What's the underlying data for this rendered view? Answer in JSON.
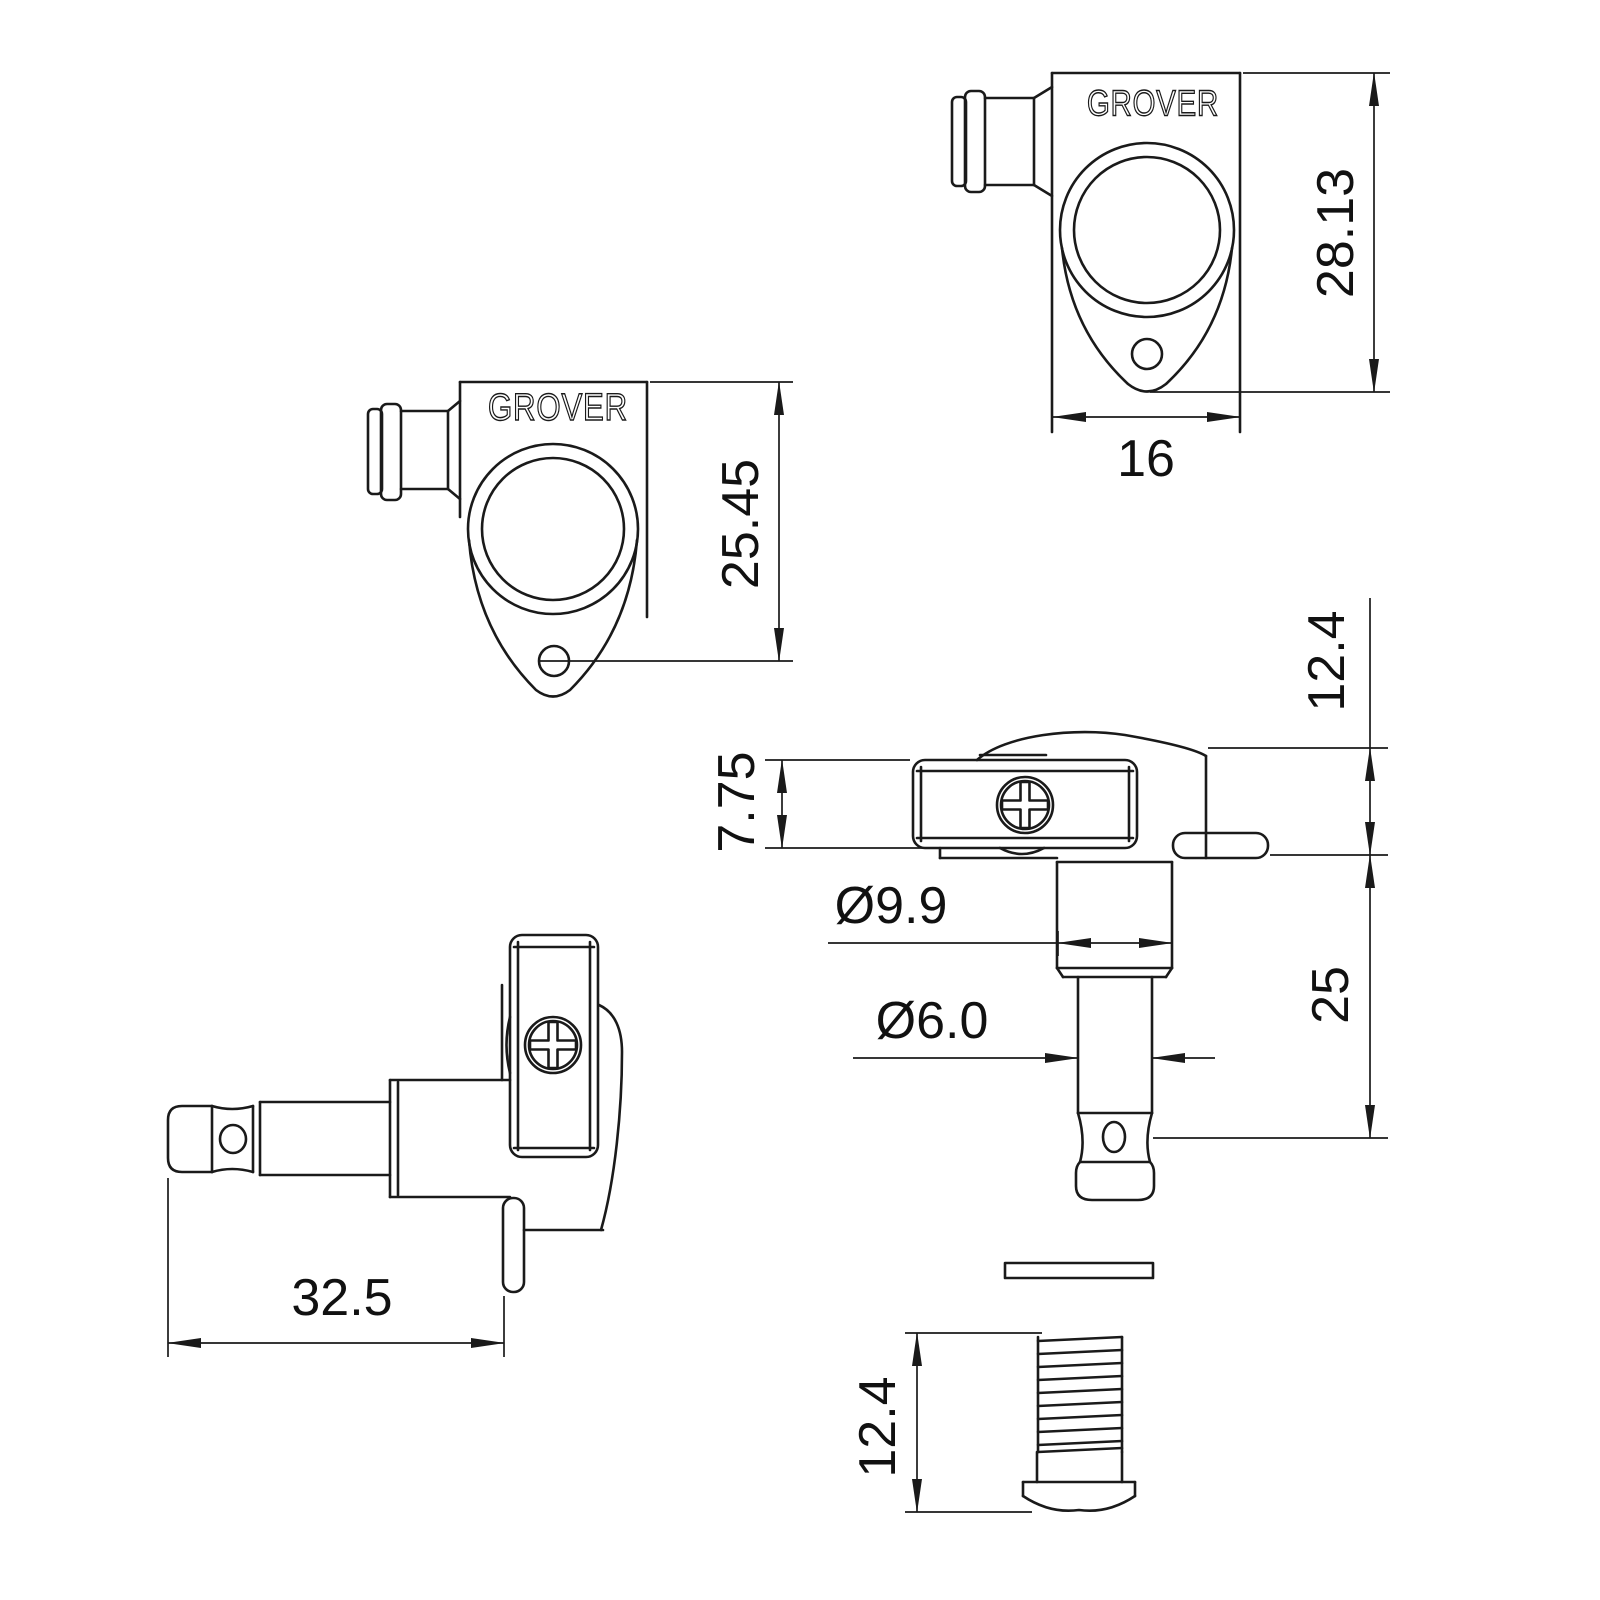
{
  "drawing": {
    "type": "technical-dimension-diagram",
    "subject": "Grover guitar tuning machine (tuner) - multi-view dimensional drawing",
    "line_color": "#1a1a1a",
    "background_color": "#ffffff",
    "brand": "GROVER",
    "views": [
      {
        "id": "front-top-right",
        "name": "front view of housing (top right)",
        "dimensions": [
          "28.13",
          "16"
        ]
      },
      {
        "id": "front-left",
        "name": "front view of housing (left)",
        "dimensions": [
          "25.45"
        ]
      },
      {
        "id": "side-right",
        "name": "side view with string post (middle right)",
        "dimensions": [
          "12.4",
          "7.75",
          "Ø9.9",
          "Ø6.0",
          "25"
        ]
      },
      {
        "id": "side-bottom-left",
        "name": "side view rotated (bottom left)",
        "dimensions": [
          "32.5"
        ]
      },
      {
        "id": "bushing",
        "name": "threaded bushing with washer (bottom right)",
        "dimensions": [
          "12.4"
        ]
      }
    ]
  },
  "labels": {
    "brand": "GROVER",
    "front_height": "28.13",
    "front_width": "16",
    "left_height_to_hole": "25.45",
    "housing_height": "12.4",
    "plate_thickness": "7.75",
    "shaft_diameter": "Ø9.9",
    "post_diameter": "Ø6.0",
    "post_length": "25",
    "overall_length": "32.5",
    "bushing_height": "12.4"
  }
}
